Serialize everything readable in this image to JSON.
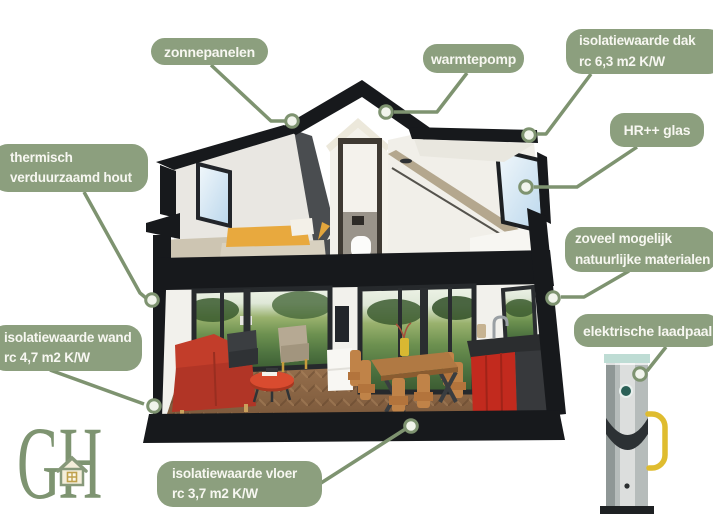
{
  "colors": {
    "label_bg": "#8c9f7e",
    "label_text": "#f7f7f1",
    "leader_line": "#7e9370",
    "marker_fill": "#f1f4ec",
    "logo_green": "#7e9471",
    "roof_black": "#17191c",
    "accent_red": "#c0392a",
    "bed_yellow": "#e8a93e",
    "cable_yellow": "#dfbc2f",
    "glass_blue": "#c7ddef"
  },
  "labels": {
    "zonnepanelen": {
      "text": "zonnepanelen"
    },
    "warmtepomp": {
      "text": "warmtepomp"
    },
    "dak": {
      "line1": "isolatiewaarde dak",
      "line2": "rc 6,3 m2 K/W"
    },
    "hr_glas": {
      "text": "HR++ glas"
    },
    "hout": {
      "line1": "thermisch",
      "line2": "verduurzaamd hout"
    },
    "materialen": {
      "line1": "zoveel mogelijk",
      "line2": "natuurlijke materialen"
    },
    "wand": {
      "line1": "isolatiewaarde wand",
      "line2": "rc 4,7 m2 K/W"
    },
    "laadpaal": {
      "text": "elektrische laadpaal"
    },
    "vloer": {
      "line1": "isolatiewaarde vloer",
      "line2": "rc 3,7 m2 K/W"
    }
  },
  "logo": {
    "text": "GH"
  }
}
